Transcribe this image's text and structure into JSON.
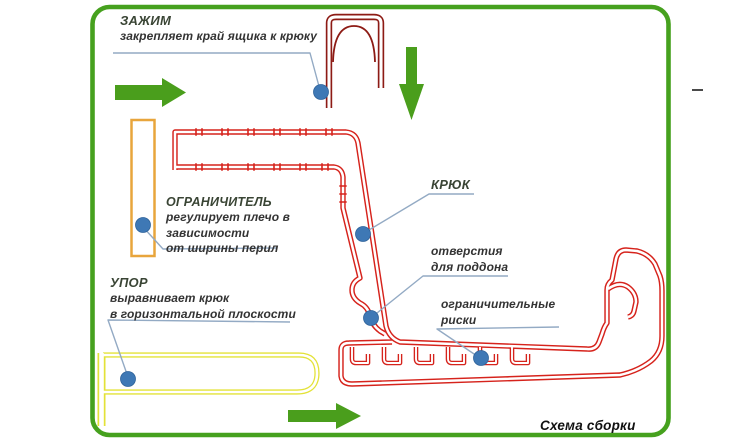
{
  "title": "Схема сборки",
  "colors": {
    "hook-red": "#d6231c",
    "clamp-red": "#8d1b15",
    "upor-yellow": "#e3e238",
    "ogr-orange": "#e8a53c",
    "frame-green": "#46a11e",
    "arrow-green": "#4a9e1c",
    "dot-blue": "#3e78b5",
    "leader-blue": "#93aac4",
    "text-dark": "#333333",
    "title-dark": "#3a4535"
  },
  "callouts": {
    "zazhim": {
      "title": "ЗАЖИМ",
      "lines": [
        "закрепляет край ящика к крюку"
      ]
    },
    "ogranichitel": {
      "title": "ОГРАНИЧИТЕЛЬ",
      "lines": [
        "регулирует плечо в",
        "зависимости",
        "от ширины перил"
      ]
    },
    "upor": {
      "title": "УПОР",
      "lines": [
        "выравнивает крюк",
        "в горизонтальной плоскости"
      ]
    },
    "kryuk": {
      "title": "КРЮК",
      "lines": []
    },
    "otverstiya": {
      "title": "",
      "lines": [
        "отверстия",
        "для поддона"
      ]
    },
    "riski": {
      "title": "",
      "lines": [
        "ограничительные",
        "риски"
      ]
    }
  },
  "icons": {
    "arrow_top_left": "arrow-right-icon",
    "arrow_top": "arrow-down-icon",
    "arrow_bottom": "arrow-right-icon"
  }
}
